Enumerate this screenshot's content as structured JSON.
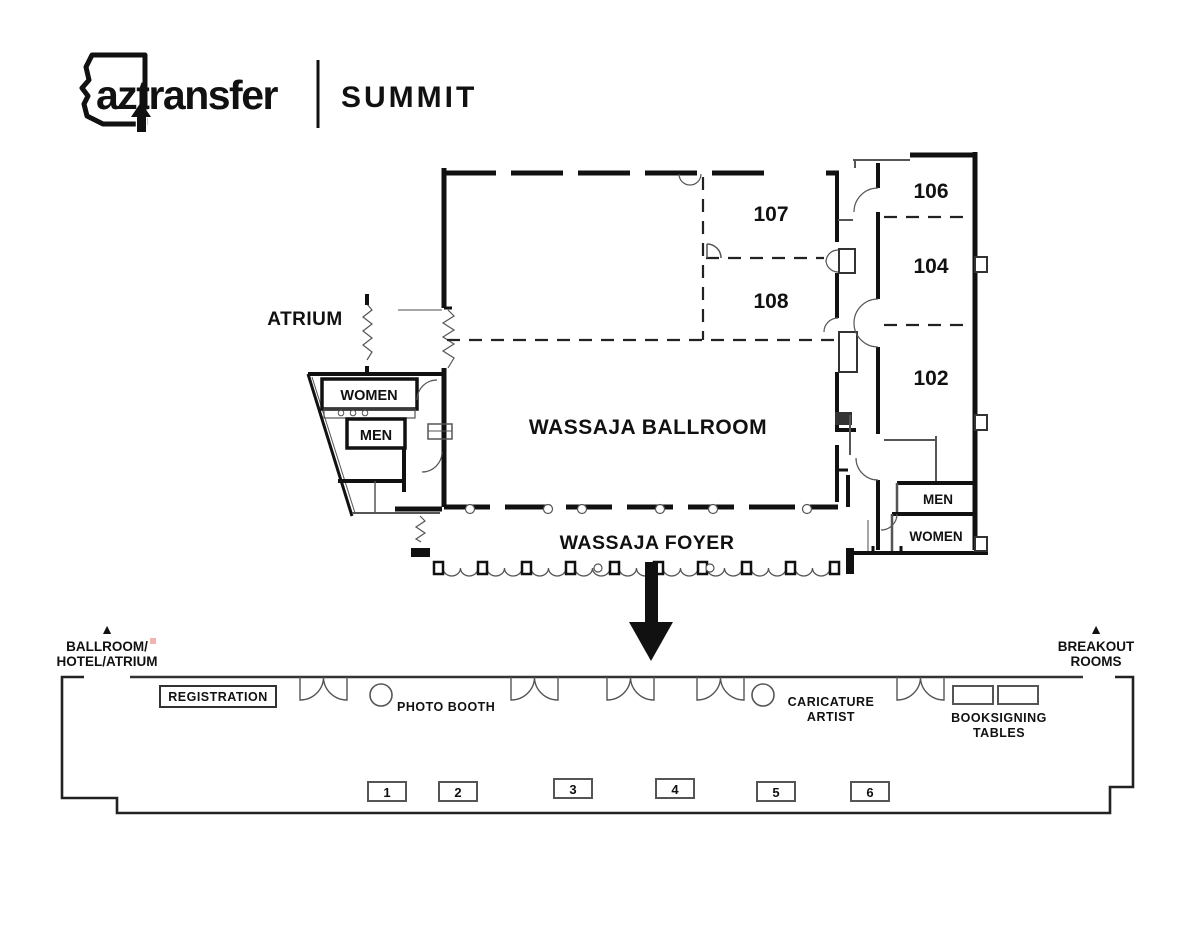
{
  "header": {
    "brand": "aztransfer",
    "event": "SUMMIT"
  },
  "floor_plan": {
    "atrium_label": "ATRIUM",
    "ballroom_label": "WASSAJA BALLROOM",
    "foyer_label": "WASSAJA FOYER",
    "rooms": {
      "room107": "107",
      "room108": "108",
      "room106": "106",
      "room104": "104",
      "room102": "102"
    },
    "restrooms_left": {
      "women": "WOMEN",
      "men": "MEN"
    },
    "restrooms_right": {
      "men": "MEN",
      "women": "WOMEN"
    }
  },
  "directions": {
    "left": {
      "marker": "▲",
      "line1": "BALLROOM/",
      "line2": "HOTEL/ATRIUM"
    },
    "right": {
      "marker": "▲",
      "line1": "BREAKOUT",
      "line2": "ROOMS"
    }
  },
  "foyer_detail": {
    "registration_label": "REGISTRATION",
    "photo_booth_label": "PHOTO BOOTH",
    "caricature_line1": "CARICATURE",
    "caricature_line2": "ARTIST",
    "booksigning_line1": "BOOKSIGNING",
    "booksigning_line2": "TABLES",
    "tables": [
      "1",
      "2",
      "3",
      "4",
      "5",
      "6"
    ]
  },
  "colors": {
    "ink": "#111111",
    "thin_line": "#555555",
    "pink_artifact": "#f2b4ae",
    "background": "#ffffff"
  }
}
